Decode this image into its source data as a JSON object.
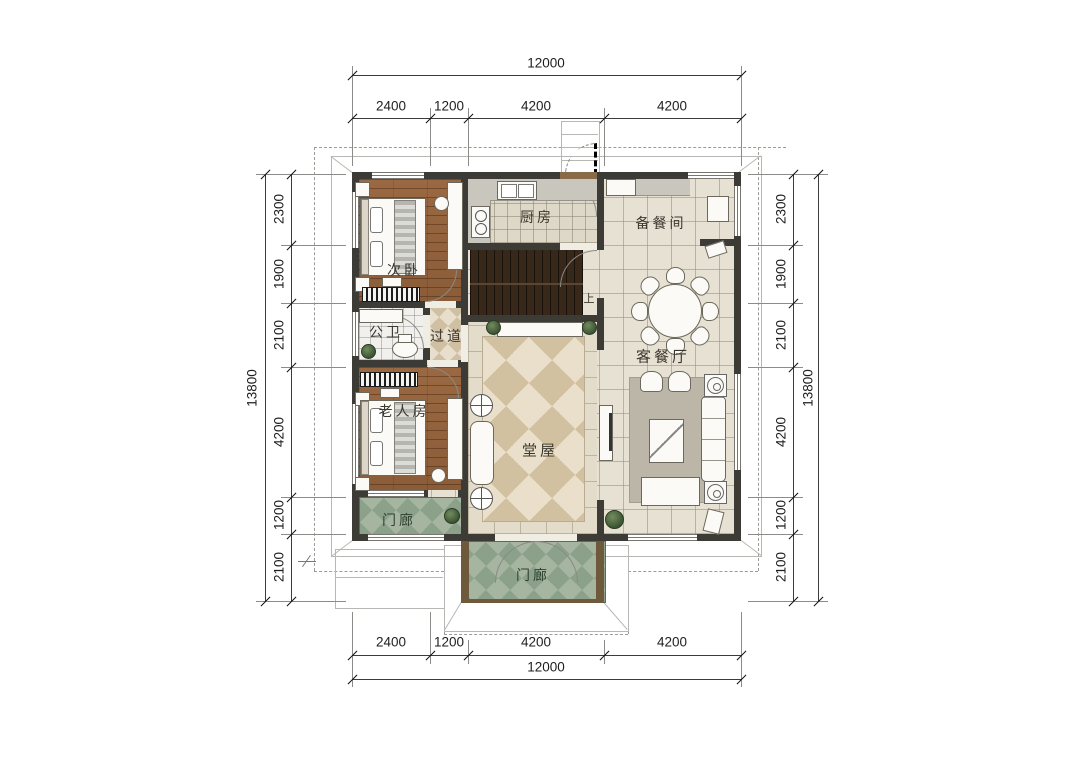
{
  "dims": {
    "h": {
      "total": "12000",
      "segments": [
        "2400",
        "1200",
        "4200",
        "4200"
      ]
    },
    "v": {
      "total": "13800",
      "segments": [
        "2300",
        "1900",
        "2100",
        "4200",
        "1200",
        "2100"
      ]
    }
  },
  "rooms": {
    "ciwo": "次卧",
    "chufang": "厨房",
    "beicanjian": "备餐间",
    "gongwei": "公卫",
    "guodao": "过道",
    "kecanting": "客餐厅",
    "laorenfang": "老人房",
    "tangwu": "堂屋",
    "menlang_left": "门廊",
    "menlang_front": "门廊",
    "stair_up": "上"
  },
  "colors": {
    "wall": "#3d3b36",
    "wood_floor": "#96663f",
    "tile_floor": "#e7e1d3",
    "hall_diamond": "#d2c1a0",
    "porch_green": "#8ba189",
    "stair_wood": "#37281a"
  }
}
